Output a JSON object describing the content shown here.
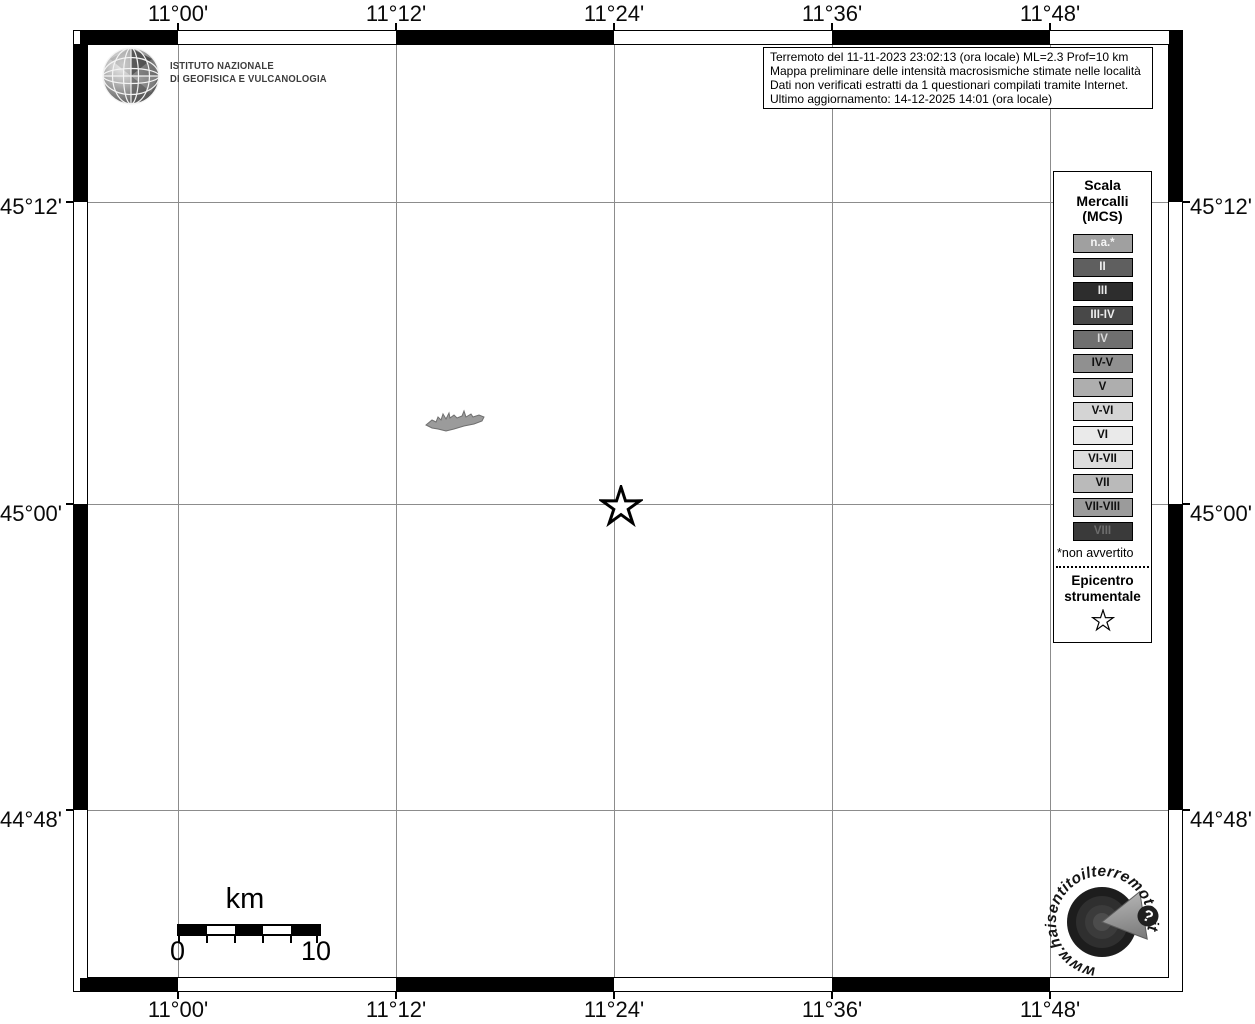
{
  "header": {
    "ingv_line1": "ISTITUTO NAZIONALE",
    "ingv_line2": "DI GEOFISICA E VULCANOLOGIA"
  },
  "info_box": {
    "line1": "Terremoto del 11-11-2023 23:02:13 (ora locale) ML=2.3 Prof=10 km",
    "line2": "Mappa preliminare delle intensità macrosismiche stimate nelle località",
    "line3": "Dati non verificati estratti da 1 questionari compilati tramite Internet.",
    "line4": "Ultimo aggiornamento: 14-12-2025 14:01 (ora locale)"
  },
  "axes": {
    "top": [
      "11°00'",
      "11°12'",
      "11°24'",
      "11°36'",
      "11°48'"
    ],
    "bottom": [
      "11°00'",
      "11°12'",
      "11°24'",
      "11°36'",
      "11°48'"
    ],
    "left": [
      "45°12'",
      "45°00'",
      "44°48'"
    ],
    "right": [
      "45°12'",
      "45°00'",
      "44°48'"
    ]
  },
  "legend": {
    "title_line1": "Scala",
    "title_line2": "Mercalli",
    "title_line3": "(MCS)",
    "items": [
      {
        "label": "n.a.*",
        "bg": "#a0a0a0",
        "fg": "#f5f5f5"
      },
      {
        "label": "II",
        "bg": "#5f5f5f",
        "fg": "#efefef"
      },
      {
        "label": "III",
        "bg": "#2d2d2d",
        "fg": "#e8e8e8"
      },
      {
        "label": "III-IV",
        "bg": "#484848",
        "fg": "#ededed"
      },
      {
        "label": "IV",
        "bg": "#6f6f6f",
        "fg": "#d8d8d8"
      },
      {
        "label": "IV-V",
        "bg": "#909090",
        "fg": "#101010"
      },
      {
        "label": "V",
        "bg": "#aeaeae",
        "fg": "#101010"
      },
      {
        "label": "V-VI",
        "bg": "#d4d4d4",
        "fg": "#101010"
      },
      {
        "label": "VI",
        "bg": "#eaeaea",
        "fg": "#101010"
      },
      {
        "label": "VI-VII",
        "bg": "#dddddd",
        "fg": "#101010"
      },
      {
        "label": "VII",
        "bg": "#bababa",
        "fg": "#101010"
      },
      {
        "label": "VII-VIII",
        "bg": "#9b9b9b",
        "fg": "#101010"
      },
      {
        "label": "VIII",
        "bg": "#3a3a3a",
        "fg": "#6d6d6d"
      }
    ],
    "footnote": "*non avvertito",
    "epicenter_line1": "Epicentro",
    "epicenter_line2": "strumentale"
  },
  "scalebar": {
    "unit": "km",
    "start": "0",
    "end": "10"
  },
  "logo_bottom": {
    "circular_text": "www.haisentitoilterremoto.it",
    "question_mark": "?"
  },
  "colors": {
    "gridline": "#8c8c8c",
    "frame": "#000000",
    "map_background": "#ffffff",
    "locality_fill": "#9b9b9b",
    "locality_stroke": "#6f6f6f"
  }
}
